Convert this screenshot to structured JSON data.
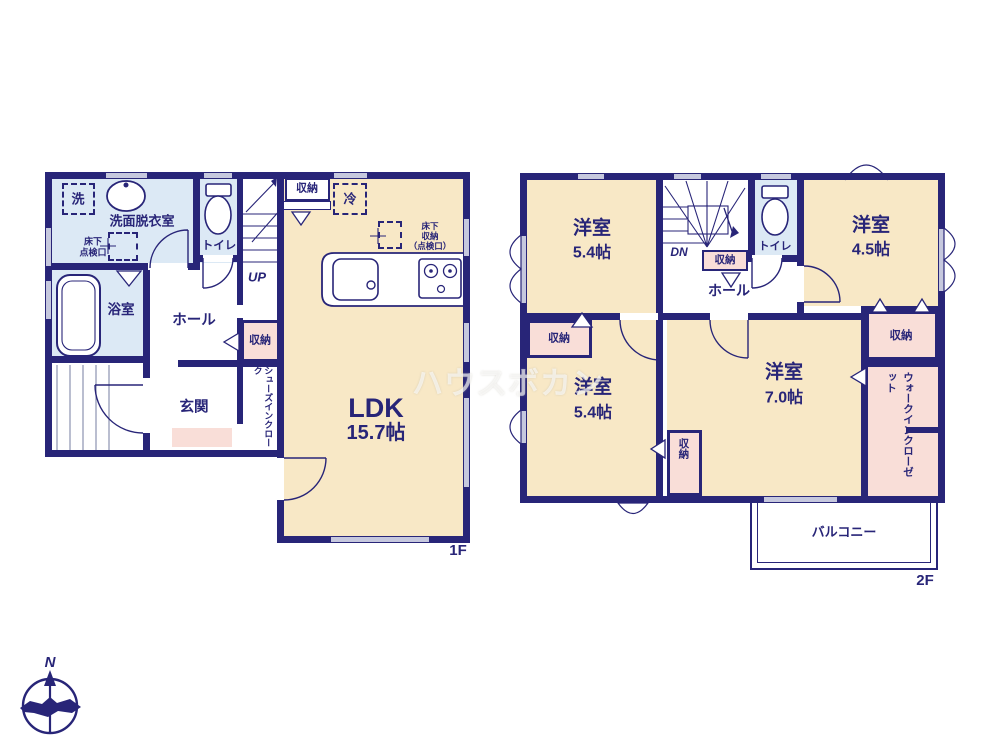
{
  "watermark": "ハウスボカン",
  "compass": {
    "north_label": "N"
  },
  "colors": {
    "wall_navy": "#282578",
    "room_cream": "#f8e8c6",
    "wet_room_blue": "#dce9f5",
    "storage_pink": "#f9ded8",
    "window_lavender": "#c6c8de"
  },
  "floor1": {
    "floor_label": "1F",
    "washer_label": "洗",
    "washroom_label": "洗面脱衣室",
    "underfloor_hatch_label": "床下\n点検口",
    "toilet_label": "トイレ",
    "stairs_label": "UP",
    "storage_top_label": "収納",
    "fridge_label": "冷",
    "underfloor_storage_label": "床下\n収納\n（点検口）",
    "bath_label": "浴室",
    "hall_label": "ホール",
    "storage_hall_label": "収納",
    "entrance_label": "玄関",
    "shoe_closet_label": "シューズインクローク",
    "ldk_label": "LDK",
    "ldk_size": "15.7帖"
  },
  "floor2": {
    "floor_label": "2F",
    "stairs_label": "DN",
    "storage_under_stairs_label": "収納",
    "toilet_label": "トイレ",
    "hall_label": "ホール",
    "bedroom_nw": {
      "name": "洋室",
      "size": "5.4帖"
    },
    "bedroom_ne": {
      "name": "洋室",
      "size": "4.5帖"
    },
    "bedroom_sw": {
      "name": "洋室",
      "size": "5.4帖"
    },
    "bedroom_se": {
      "name": "洋室",
      "size": "7.0帖"
    },
    "storage_nw_label": "収納",
    "storage_sw_label": "収納",
    "storage_ne_label": "収納",
    "walkin_closet_label": "ウォークインクローゼット",
    "balcony_label": "バルコニー"
  }
}
